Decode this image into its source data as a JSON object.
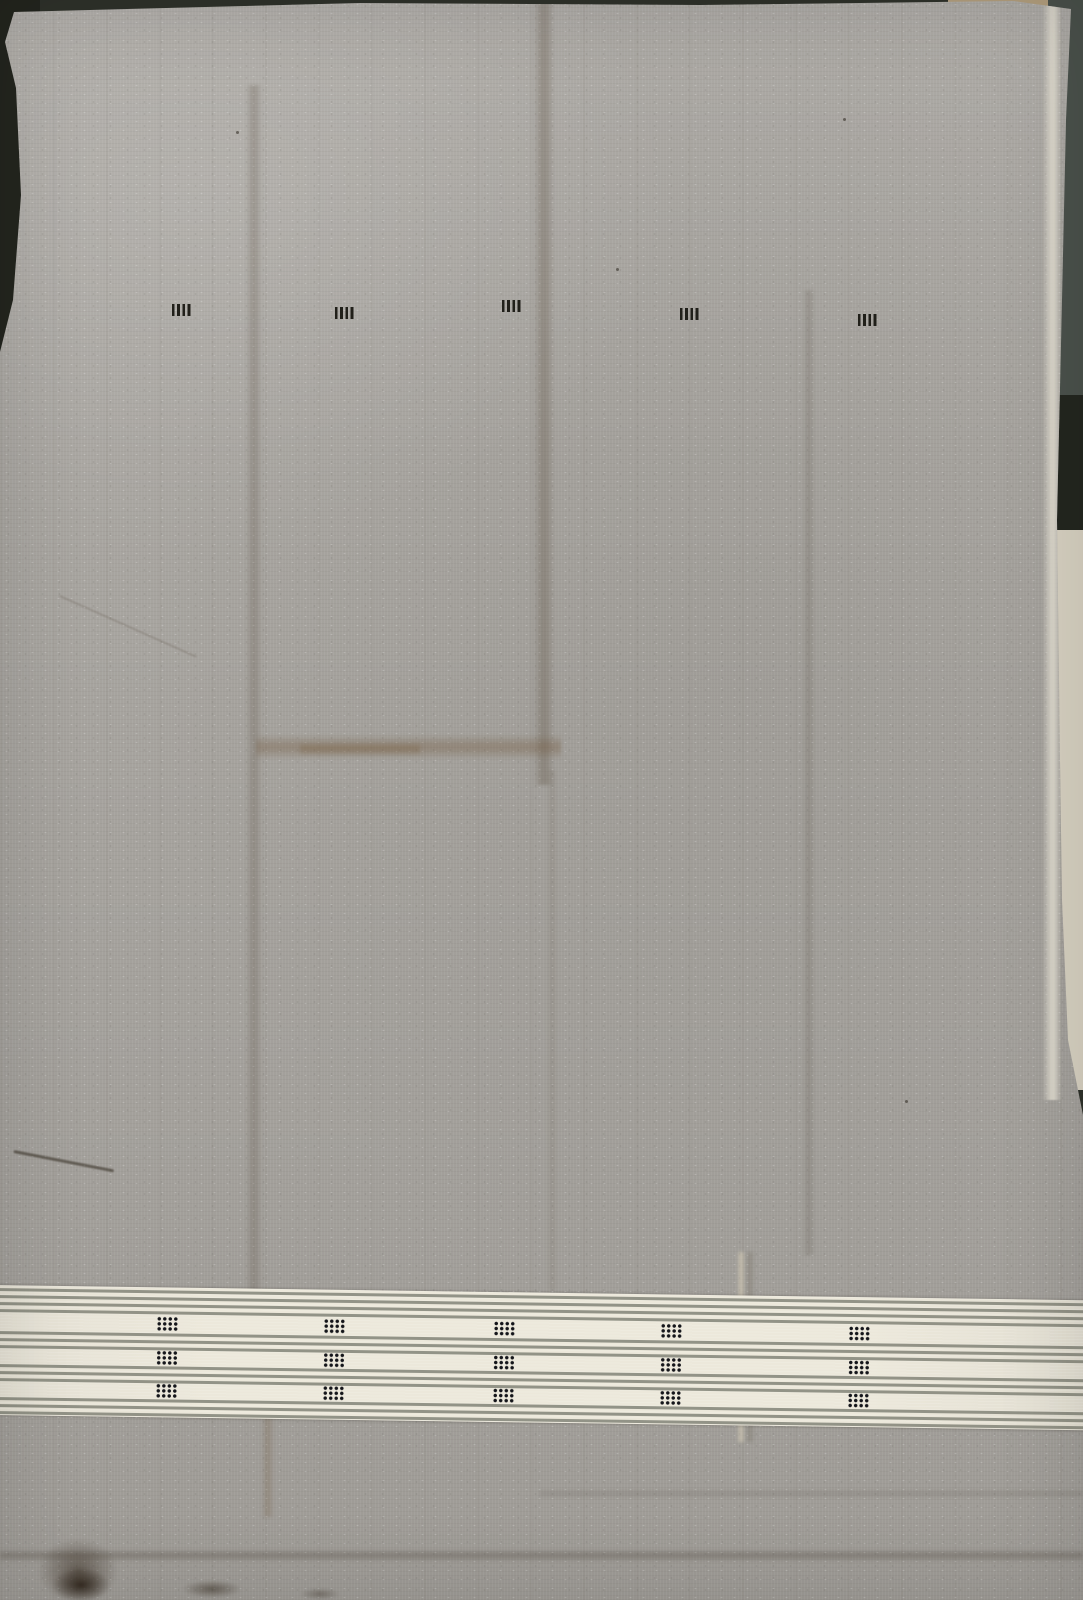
{
  "scene": {
    "description": "Photograph of a plain grey handwoven cotton fabric laid flat. A row of five small black tally-mark motifs sits near the top. Near the bottom runs a cream border band of thin grey pinstripes with three rows of small black dotted-square motifs. Fold creases cross the cloth; a dark surface shows at the edges.",
    "palette": {
      "fabric_gray": "#a8a5a0",
      "band_cream": "#ece8db",
      "band_stripe": "#82846f",
      "motif_black": "#15140e",
      "background_dark": "#2e312a",
      "background_slate": "#4a514b",
      "background_cream": "#d6d0c0",
      "background_tan": "#b29e7d"
    }
  },
  "background": {
    "base_color": "#2e312a",
    "patches": [
      {
        "name": "bg-right-slate",
        "x": 1040,
        "y": 0,
        "w": 43,
        "h": 540,
        "color": "#4a514b"
      },
      {
        "name": "bg-right-notch",
        "x": 1038,
        "y": 395,
        "w": 45,
        "h": 140,
        "color": "#23261f"
      },
      {
        "name": "bg-right-cream",
        "x": 1042,
        "y": 530,
        "w": 41,
        "h": 560,
        "color": "#d6d0c0"
      },
      {
        "name": "bg-tan-patch",
        "x": 948,
        "y": 0,
        "w": 100,
        "h": 12,
        "color": "#b29e7d"
      },
      {
        "name": "bg-left-dark",
        "x": 0,
        "y": 0,
        "w": 40,
        "h": 380,
        "color": "#23251e"
      }
    ]
  },
  "selvage": {
    "x": 1042,
    "y": 0,
    "w": 20,
    "h": 1100
  },
  "top_motif_row": {
    "motif_shape": "four short vertical black dashes",
    "motifs": [
      {
        "x": 182,
        "y": 310
      },
      {
        "x": 345,
        "y": 313
      },
      {
        "x": 512,
        "y": 306
      },
      {
        "x": 690,
        "y": 314
      },
      {
        "x": 868,
        "y": 320
      }
    ]
  },
  "band": {
    "left": -6,
    "top": 1285,
    "width": 1096,
    "height": 130,
    "tilt_deg": 0.8,
    "background": "#ece8db",
    "stripe_color": "rgba(130,132,120,0.85)",
    "stripe_height": 2.6,
    "stripe_offsets_y": [
      3,
      10,
      17,
      24,
      46,
      53,
      60,
      79,
      86,
      93,
      112,
      119,
      126
    ],
    "motif_shape": "grid of 4x3 black dots",
    "motif_columns_x": [
      174,
      341,
      511,
      678,
      866
    ],
    "motif_row_offsets_y": [
      29,
      63,
      96
    ]
  },
  "creases": [
    {
      "axis": "v",
      "x": 246,
      "y": 85,
      "w": 16,
      "h": 1330,
      "color": "rgba(75,62,48,0.20)"
    },
    {
      "axis": "v",
      "x": 534,
      "y": 0,
      "w": 20,
      "h": 785,
      "color": "rgba(82,68,50,0.26)"
    },
    {
      "axis": "v",
      "x": 547,
      "y": 770,
      "w": 10,
      "h": 520,
      "color": "rgba(82,68,50,0.10)"
    },
    {
      "axis": "v",
      "x": 803,
      "y": 290,
      "w": 12,
      "h": 965,
      "color": "rgba(70,62,50,0.15)"
    },
    {
      "axis": "h",
      "x": 256,
      "y": 735,
      "w": 305,
      "h": 24,
      "color": "rgba(112,86,58,0.32)"
    },
    {
      "axis": "h",
      "x": 300,
      "y": 742,
      "w": 120,
      "h": 14,
      "color": "rgba(120,95,62,0.30)"
    },
    {
      "axis": "h",
      "x": 0,
      "y": 1549,
      "w": 1083,
      "h": 13,
      "color": "rgba(70,62,52,0.26)"
    },
    {
      "axis": "h",
      "x": 540,
      "y": 1489,
      "w": 543,
      "h": 9,
      "color": "rgba(70,62,52,0.12)"
    },
    {
      "axis": "v",
      "x": 737,
      "y": 1252,
      "w": 8,
      "h": 190,
      "color": "rgba(222,212,188,0.55)"
    },
    {
      "axis": "v",
      "x": 746,
      "y": 1252,
      "w": 8,
      "h": 190,
      "color": "rgba(100,92,75,0.25)"
    },
    {
      "axis": "v",
      "x": 262,
      "y": 1412,
      "w": 12,
      "h": 105,
      "color": "rgba(112,86,58,0.22)"
    },
    {
      "axis": "d",
      "x": 14,
      "y": 1150,
      "w": 102,
      "h": 3,
      "rot": 11,
      "color": "rgba(45,38,28,0.55)"
    },
    {
      "axis": "d",
      "x": 60,
      "y": 595,
      "w": 150,
      "h": 2,
      "rot": 24,
      "color": "rgba(80,72,60,0.22)"
    }
  ],
  "spots": [
    {
      "x": 38,
      "y": 1538,
      "w": 80,
      "h": 66,
      "color": "rgba(52,40,28,0.55)"
    },
    {
      "x": 52,
      "y": 1568,
      "w": 58,
      "h": 34,
      "color": "rgba(40,30,20,0.85)"
    },
    {
      "x": 182,
      "y": 1580,
      "w": 60,
      "h": 18,
      "color": "rgba(48,38,26,0.50)"
    },
    {
      "x": 300,
      "y": 1588,
      "w": 40,
      "h": 12,
      "color": "rgba(48,38,26,0.35)"
    }
  ],
  "specks": [
    {
      "x": 616,
      "y": 268
    },
    {
      "x": 843,
      "y": 118
    },
    {
      "x": 236,
      "y": 131
    },
    {
      "x": 905,
      "y": 1100
    }
  ]
}
